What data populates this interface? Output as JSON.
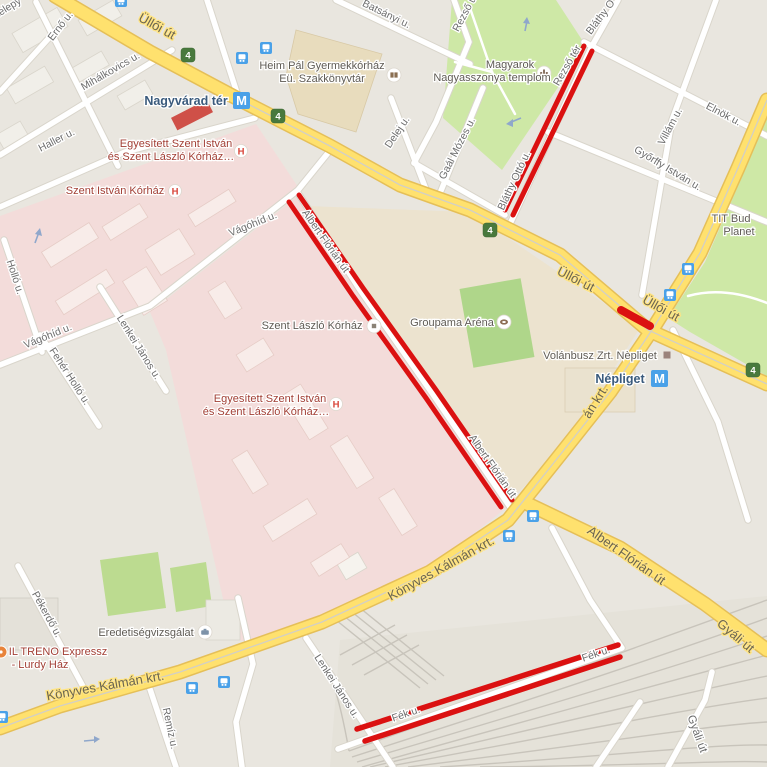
{
  "roads": {
    "ulloi": "Üllői út",
    "konyves": "Könyves Kálmán krt.",
    "konyves_partial": "án krt.",
    "albert_florian": "Albert Flórián út",
    "gyali": "Gyáli út"
  },
  "streets": {
    "telepy": "telepy",
    "erno": "Ernő u.",
    "mihalkovics": "Mihálkovics u.",
    "haller": "Haller u.",
    "hollo": "Holló u.",
    "vagohid": "Vágóhíd u.",
    "feher_hollo": "Fehér Holló u.",
    "lenkei": "Lenkei János u.",
    "pekerdo": "Pékerdő u.",
    "remiz": "Remíz u.",
    "batsanyi": "Batsányi u.",
    "rezso": "Rezső u.",
    "rezso_ter": "Rezső tér",
    "delej": "Delej u.",
    "gaal_mozes": "Gaál Mózes u.",
    "villam": "Villám u.",
    "elnok": "Elnök u.",
    "gyorffy": "Győrffy István u.",
    "blathy": "Bláthy Ottó u.",
    "blathy_partial": "Bláthy O",
    "fek": "Fék u."
  },
  "pois": {
    "heim_line1": "Heim Pál Gyermekkórház",
    "heim_line2": "Eü. Szakkönyvtár",
    "magyarok_line1": "Magyarok",
    "magyarok_line2": "Nagyasszonya templom",
    "groupama": "Groupama Aréna",
    "szent_laszlo": "Szent László Kórház",
    "volanbusz": "Volánbusz Zrt. Nèpliget",
    "eredetiseg": "Eredetiségvizsgálat",
    "tit_line1": "TIT Bud",
    "tit_line2": "Planet",
    "egyesitett_line1": "Egyesített Szent István",
    "egyesitett_line2": "és Szent László Kórház…",
    "szent_istvan": "Szent István Kórház",
    "iltreno_line1": "IL TRENO Expressz",
    "iltreno_line2": "- Lurdy Ház",
    "hospital_badge": "H"
  },
  "transit": {
    "nagyvarad": "Nagyvárad tér",
    "nepliget": "Népliget",
    "metro": "M",
    "route_badge": "4"
  },
  "colors": {
    "route_highlight": "#db1111",
    "major_road_fill": "#ffe16e",
    "major_road_casing": "#e5bf58",
    "park_green": "#cee8a6",
    "pitch_green": "#afd68a",
    "hospital_area_pink": "#f3dcda",
    "metro_blue": "#4aa1e8",
    "route_badge_green": "#48793d",
    "hospital_label_maroon": "#a23f35",
    "transit_label_blue": "#3a5a7c",
    "background": "#e9e6df"
  }
}
